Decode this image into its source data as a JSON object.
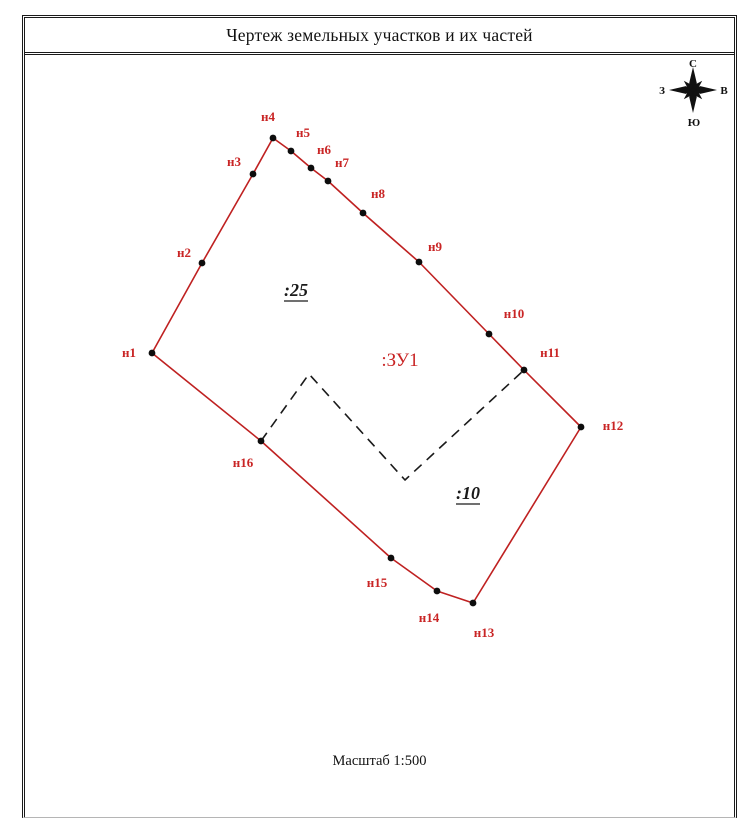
{
  "title": "Чертеж земельных участков и их частей",
  "scale_label": "Масштаб 1:500",
  "compass": {
    "north": "С",
    "east": "В",
    "south": "Ю",
    "west": "З",
    "center_x": 693,
    "center_y": 90
  },
  "colors": {
    "boundary_red": "#bf2121",
    "label_red": "#c92525",
    "ink": "#1a1a1a"
  },
  "parcel_labels": [
    {
      "label": ":25",
      "x": 296,
      "y": 296,
      "style": "outline-black",
      "underline": true
    },
    {
      "label": ":ЗУ1",
      "x": 400,
      "y": 366,
      "style": "new-parcel-red",
      "underline": false
    },
    {
      "label": ":10",
      "x": 468,
      "y": 499,
      "style": "outline-black",
      "underline": true
    }
  ],
  "boundary_points": [
    {
      "name": "н1",
      "x": 152,
      "y": 353,
      "lx": 129,
      "ly": 357
    },
    {
      "name": "н2",
      "x": 202,
      "y": 263,
      "lx": 184,
      "ly": 257
    },
    {
      "name": "н3",
      "x": 253,
      "y": 174,
      "lx": 234,
      "ly": 166
    },
    {
      "name": "н4",
      "x": 273,
      "y": 138,
      "lx": 268,
      "ly": 121
    },
    {
      "name": "н5",
      "x": 291,
      "y": 151,
      "lx": 303,
      "ly": 137
    },
    {
      "name": "н6",
      "x": 311,
      "y": 168,
      "lx": 324,
      "ly": 154
    },
    {
      "name": "н7",
      "x": 328,
      "y": 181,
      "lx": 342,
      "ly": 167
    },
    {
      "name": "н8",
      "x": 363,
      "y": 213,
      "lx": 378,
      "ly": 198
    },
    {
      "name": "н9",
      "x": 419,
      "y": 262,
      "lx": 435,
      "ly": 251
    },
    {
      "name": "н10",
      "x": 489,
      "y": 334,
      "lx": 514,
      "ly": 318
    },
    {
      "name": "н11",
      "x": 524,
      "y": 370,
      "lx": 550,
      "ly": 357
    },
    {
      "name": "н12",
      "x": 581,
      "y": 427,
      "lx": 613,
      "ly": 430
    },
    {
      "name": "н13",
      "x": 473,
      "y": 603,
      "lx": 484,
      "ly": 637
    },
    {
      "name": "н14",
      "x": 437,
      "y": 591,
      "lx": 429,
      "ly": 622
    },
    {
      "name": "н15",
      "x": 391,
      "y": 558,
      "lx": 377,
      "ly": 587
    },
    {
      "name": "н16",
      "x": 261,
      "y": 441,
      "lx": 243,
      "ly": 467
    }
  ],
  "divider": [
    [
      261,
      441
    ],
    [
      309,
      374
    ],
    [
      405,
      480
    ],
    [
      524,
      370
    ]
  ]
}
